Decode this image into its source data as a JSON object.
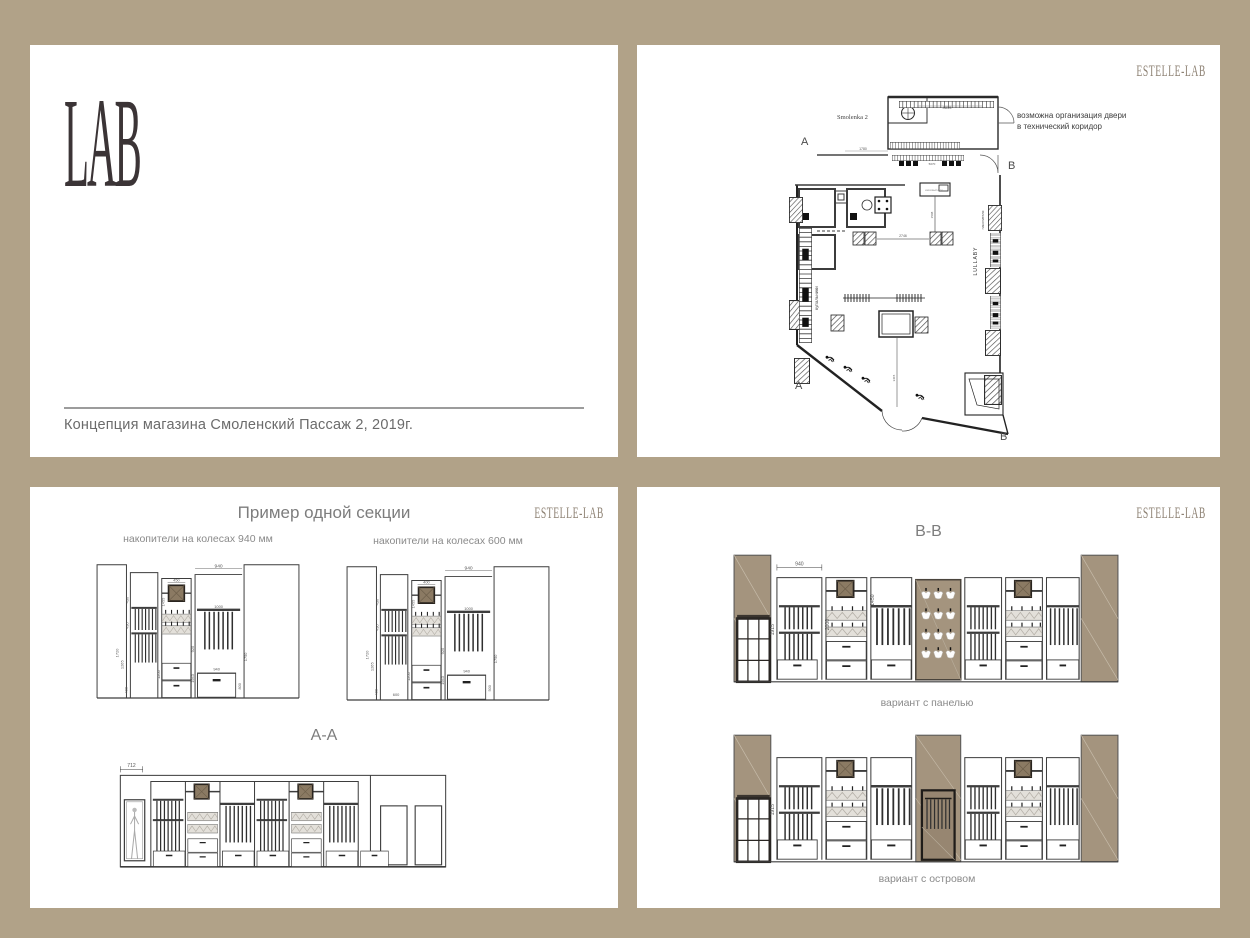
{
  "colors": {
    "background": "#b1a288",
    "card": "#ffffff",
    "ink": "#3b3436",
    "gray_text": "#7a7a7a",
    "brand_brown": "#8d8173",
    "taupe_panel": "#a4947e",
    "wood_square": "#8b7a63"
  },
  "cover": {
    "logo": "LAB",
    "caption": "Концепция магазина Смоленский Пассаж 2, 2019г."
  },
  "plan": {
    "brand": "ESTELLE-LAB",
    "title": "Smolenka 2",
    "markers": {
      "a": "А",
      "b": "В"
    },
    "annotation_line1": "возможна организация двери",
    "annotation_line2": "в технический коридор",
    "labels": {
      "left_wall": "купальники",
      "right_wall_upper": "накопители",
      "right_wall_lower": "LULLABY",
      "cash_desk": "кассовый стол"
    },
    "dims": {
      "top_shelf": "4835",
      "fitting": "1780",
      "racks": "5070",
      "center": "2746",
      "front": "3415",
      "desk": "1508"
    }
  },
  "sections": {
    "brand": "ESTELLE-LAB",
    "title": "Пример одной секции",
    "label_940": "накопители на колесах 940 мм",
    "label_600": "накопители на колесах 600 мм",
    "aa_title": "А-А",
    "aa_dim": "712",
    "dims_common": {
      "top_width": "940",
      "shelf": "1000",
      "panel_height": "1455",
      "row1": "430",
      "row2": "430",
      "h1": "1720",
      "h2": "1265",
      "h3": "400",
      "drawer_h": "1200",
      "unit_h": "1943",
      "col_h": "920",
      "right_h": "1750"
    },
    "variant_940": {
      "panel_width": "450",
      "drawer_w": "940",
      "side_h": "800"
    },
    "variant_600": {
      "panel_width": "400",
      "drawer_w": "600",
      "side_h": "500"
    }
  },
  "bb": {
    "brand": "ESTELLE-LAB",
    "title": "В-В",
    "label_panel": "вариант с панелью",
    "label_island": "вариант с островом",
    "dims": {
      "bay_width": "940",
      "height": "1915",
      "mid_height": "2000",
      "panel_height": "1450",
      "island_height": "1915"
    }
  }
}
